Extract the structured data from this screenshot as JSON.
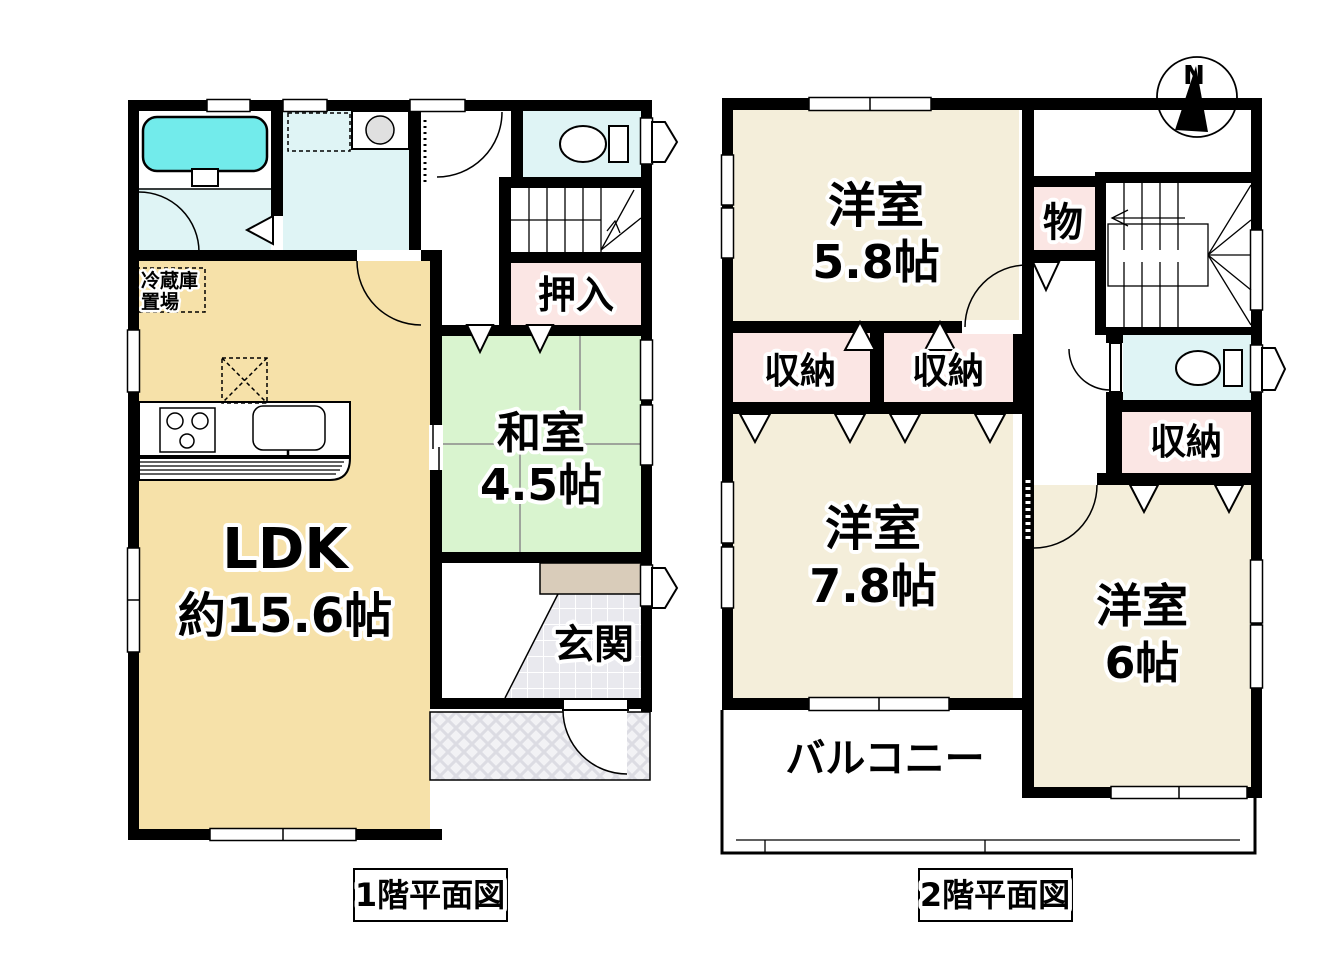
{
  "compass": {
    "north_label": "N"
  },
  "colors": {
    "wall": "#000000",
    "ldk": "#F6E1A9",
    "tatami_room": "#D9F4CF",
    "western_room": "#F4EEDA",
    "closet_pink": "#FBE6E4",
    "water_room": "#DFF4F5",
    "bathtub": "#72EBEB",
    "washer_drum": "#E0E0E0",
    "shoe_cabinet": "#D9CCBA"
  },
  "floor1": {
    "caption": "1階平面図",
    "rooms": {
      "ldk": {
        "name": "LDK",
        "size": "約15.6帖"
      },
      "washitsu": {
        "name": "和室",
        "size": "4.5帖"
      },
      "oshiire": {
        "name": "押入"
      },
      "genkan": {
        "name": "玄関"
      },
      "fridge": {
        "line1": "冷蔵庫",
        "line2": "置場"
      }
    }
  },
  "floor2": {
    "caption": "2階平面図",
    "rooms": {
      "yoshitsu_58": {
        "name": "洋室",
        "size": "5.8帖"
      },
      "yoshitsu_78": {
        "name": "洋室",
        "size": "7.8帖"
      },
      "yoshitsu_6": {
        "name": "洋室",
        "size": "6帖"
      },
      "mono": {
        "name": "物"
      },
      "shuno_a": {
        "name": "収納"
      },
      "shuno_b": {
        "name": "収納"
      },
      "shuno_c": {
        "name": "収納"
      },
      "balcony": {
        "name": "バルコニー"
      }
    }
  }
}
